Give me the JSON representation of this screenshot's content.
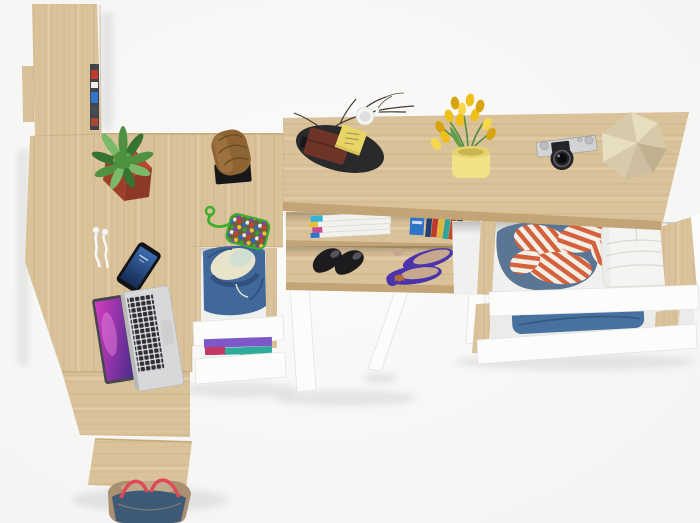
{
  "meta": {
    "type": "product-render-photo",
    "description": "Top-down bird's-eye view of a light sonoma-oak home office / hallway furniture set on a white floor: a tall wall column with shelves, a corner desk with laptop, phone, earphones, plant and log stool, an under-desk drawer unit with clothes, a console desk with magazine shelf and shoes, and a chest with open drawers full of folded clothes.",
    "width": 700,
    "height": 523
  },
  "furniture": [
    {
      "name": "wall-column-hutch",
      "label": "Tall oak wall column with edge-on shelf compartments"
    },
    {
      "name": "corner-desk",
      "label": "L-shaped oak corner desk surface"
    },
    {
      "name": "under-desk-drawer-unit",
      "label": "Open white drawers with denim jacket and folded clothes"
    },
    {
      "name": "console-desk",
      "label": "Oak console desk with magazine shelf, book row and shoe shelf, white A-frame legs"
    },
    {
      "name": "chest-of-drawers",
      "label": "Oak chest with two open white drawers of folded clothes"
    }
  ],
  "objects": [
    {
      "name": "potted-fern",
      "label": "Speckled fern in red square planter"
    },
    {
      "name": "log-stool",
      "label": "Wooden log stool on black base"
    },
    {
      "name": "beaded-keychain",
      "label": "Multicolour beaded pouch with green cord"
    },
    {
      "name": "earbuds",
      "label": "White earphones cable"
    },
    {
      "name": "smartphone",
      "label": "Black smartphone with blue screen"
    },
    {
      "name": "laptop",
      "label": "Silver laptop with purple galaxy wallpaper"
    },
    {
      "name": "desk-organizer-tray",
      "label": "Black oval tray with wallet, sticky notes and mug"
    },
    {
      "name": "twig-decor",
      "label": "Decorative dry twigs"
    },
    {
      "name": "tulip-bouquet",
      "label": "Yellow tulips in pale-yellow vase"
    },
    {
      "name": "vintage-camera",
      "label": "Silver retro camera with black lens"
    },
    {
      "name": "faceted-ornament",
      "label": "Beige faceted polyhedron ornament"
    },
    {
      "name": "magazine-stack",
      "label": "Stack of white magazines with coloured spines"
    },
    {
      "name": "book-row",
      "label": "Row of colourful books"
    },
    {
      "name": "black-heels",
      "label": "Pair of black high-heel pumps"
    },
    {
      "name": "purple-flats",
      "label": "Pair of purple ballet flats with tan insole"
    },
    {
      "name": "denim-jacket",
      "label": "Denim jacket with cream lining in open drawer"
    },
    {
      "name": "folded-clothes-stack",
      "label": "Purple / teal / magenta folded clothes in lower drawer"
    },
    {
      "name": "striped-shirt",
      "label": "Crumpled red-white striped shirt on denim in drawer"
    },
    {
      "name": "white-folded-pants",
      "label": "White folded trousers in drawer"
    },
    {
      "name": "folded-jeans",
      "label": "Folded blue jeans in lower drawer"
    },
    {
      "name": "handbag",
      "label": "Navy and tan handbag with red straps"
    }
  ],
  "palette": {
    "floor": "#f3f3f2",
    "floorLight": "#fbfbfa",
    "wood": "#dac29a",
    "woodGrain": "#b2935f",
    "woodHi": "#efe0bf",
    "woodEdge": "#c3a476",
    "white": "#fcfcfb",
    "whiteShade": "#e3e3e1",
    "interior": "#f0f0ee",
    "interior2": "#ebebe9",
    "shadow": "rgba(0,0,0,0.08)",
    "shadowInk": "#000000",
    "trayBlack": "#2a2a2d",
    "wallet": "#6e3428",
    "walletLine": "#4f241a",
    "sticky": "#e9d566",
    "stickyLine": "#9a9160",
    "branch": "#32281e",
    "mug": "#f5f5f3",
    "mugInner": "#dfdfdd",
    "tulip": "#efc019",
    "tulipLight": "#f7d84d",
    "tulipDark": "#d8a411",
    "stem": "#4f8c3c",
    "leafBlade": "#619e48",
    "vase": "#f1e287",
    "vaseTop": "#e6d36e",
    "vaseInner": "#c9b64e",
    "cameraSilver": "#d2d3d5",
    "cameraDial": "#bdbec1",
    "cameraStroke": "#97989b",
    "cameraDark": "#242428",
    "lensRing": "#5e5e64",
    "lensInner": "#0a0a0c",
    "decor": "#d7caaa",
    "decorLight": "#e7ddc1",
    "decorMid": "#ccbe9e",
    "decorDark": "#bfb190",
    "pot": "#b04832",
    "potMid": "#a03f29",
    "potDark": "#8c3a25",
    "fern": "#4e9140",
    "fernDark": "#377330",
    "fernLight": "#7ab968",
    "log": "#8f6434",
    "logDark": "#6d4a22",
    "logLight": "#a87e4c",
    "standBlack": "#17171a",
    "cord": "#3fae2f",
    "pouchBg": "#6b5f40",
    "beadRed": "#d23b30",
    "beadBlue": "#2e66c9",
    "beadYellow": "#e8c52c",
    "beadGreen": "#36a13a",
    "beadPurple": "#8a3bbf",
    "beadWhite": "#ededed",
    "earphone": "#f7f7f5",
    "earphoneShade": "#d5d5d3",
    "phoneBody": "#121217",
    "phoneScreenA": "#3b6bb0",
    "phoneScreenB": "#152c52",
    "laptopSilver": "#d6d8da",
    "laptopEdge": "#b6b8ba",
    "lidDark": "#46464c",
    "key": "#2f2f33",
    "trackpad": "#cdcfd1",
    "screenA": "#d23ec0",
    "screenB": "#4c2a8e",
    "screenPink": "#ef86e0",
    "denim": "#41689b",
    "denimDark": "#2e4f78",
    "lining": "#e8e4c9",
    "mint": "#cfe0d2",
    "foldPurple": "#7e57c8",
    "foldTeal": "#2eab9a",
    "foldMagenta": "#c23967",
    "foldWhite": "#f0f0ee",
    "foldGreen": "#53a05b",
    "stripeRed": "#d4603c",
    "stripeWhite": "#f3efe7",
    "shirtDenim": "#5a7694",
    "pantsWhite": "#f4f4f2",
    "pantsLine": "#d9d8d2",
    "jeans": "#47719f",
    "jeansDark": "#35587e",
    "heel": "#1d1b1e",
    "heelIn": "#55545c",
    "flat": "#4a33ad",
    "flatIn": "#c6a88e",
    "bow": "#b06a38",
    "magPage": "#f2f1ee",
    "magEdge": "#d7d5d0",
    "magCyan": "#38b2d4",
    "magMagenta": "#c94a92",
    "magYellow": "#e2c03a",
    "bookBlue": "#2f76c9",
    "bookNavy": "#24406e",
    "bookRed": "#c03a2e",
    "bookYellow": "#e0b53a",
    "bookTeal": "#2fa398",
    "bookRust": "#b84a2e",
    "bookDark": "#474b54",
    "bagNavy": "#3d5a77",
    "bagTan": "#a99071",
    "bagTanLight": "#c1ab8a",
    "bagRed": "#e04a58",
    "slitDark": "#43434b"
  }
}
